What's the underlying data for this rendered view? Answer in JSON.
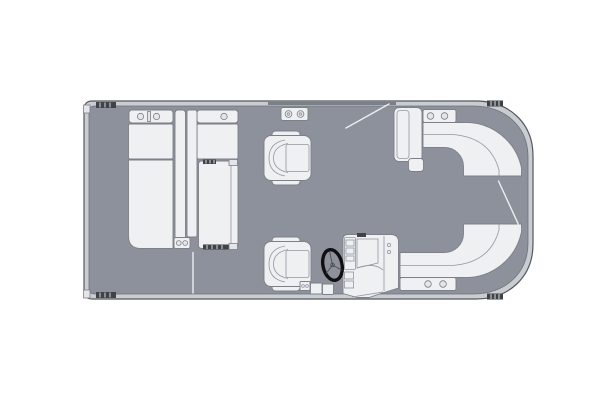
{
  "diagram": {
    "title": "Pontoon boat floor plan (top view)",
    "type": "floorplan-top-view",
    "colors": {
      "background": "#ffffff",
      "deck": "#8c919b",
      "hull_rail": "#c9ccd1",
      "hull_line": "#55585e",
      "furniture": "#eef0f2",
      "furniture_stroke": "#7c8088",
      "cup": "#e3e5e8",
      "detail_dark": "#3f4246",
      "tick": "#d5d8dc",
      "gate_line": "#eceef0",
      "wheel": "#101012"
    },
    "components": [
      {
        "id": "hull-outline",
        "label": "Pontoon hull outline with rub rail"
      },
      {
        "id": "deck-floor",
        "label": "Gray deck floor"
      },
      {
        "id": "cleat",
        "label": "Dock cleat (hatched), four positions"
      },
      {
        "id": "aft-lounge-group",
        "label": "Aft L-shaped wraparound lounge seating with cupholders"
      },
      {
        "id": "aft-chaise-right",
        "label": "Aft chaise cushion with headrest marks"
      },
      {
        "id": "side-table-cupholders",
        "label": "Side table with two cupholders"
      },
      {
        "id": "captain-chair-companion",
        "label": "Companion captain's chair"
      },
      {
        "id": "captain-chair-helm",
        "label": "Helm captain's chair"
      },
      {
        "id": "steering-wheel",
        "label": "Steering wheel"
      },
      {
        "id": "helm-console",
        "label": "Helm console with dashboard"
      },
      {
        "id": "step-boxes",
        "label": "Small step / storage boxes beside helm"
      },
      {
        "id": "bow-chaise-lounger",
        "label": "Bow chaise lounger with footrest"
      },
      {
        "id": "bow-curved-bench-top",
        "label": "Curved corner bench, upper bow"
      },
      {
        "id": "bow-curved-bench-bottom",
        "label": "Curved corner bench, lower bow, with cupholders"
      },
      {
        "id": "gate-swing-top",
        "label": "Open gate swing line, top side"
      },
      {
        "id": "gate-swing-right",
        "label": "Open gate swing line, bow entry"
      },
      {
        "id": "gate-line-bottom-left",
        "label": "Gate seam line, bottom side"
      }
    ]
  }
}
